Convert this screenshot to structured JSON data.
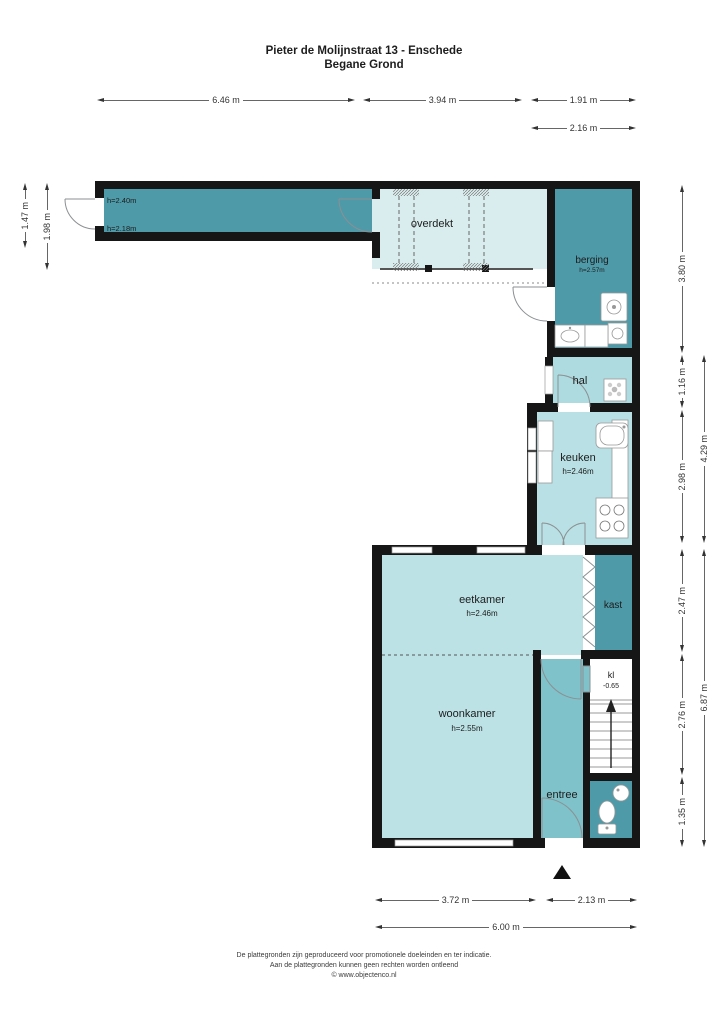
{
  "title": {
    "line1": "Pieter de Molijnstraat 13 - Enschede",
    "line2": "Begane Grond"
  },
  "rooms": {
    "corridor": {
      "height_top": "h=2.40m",
      "height_bottom": "h=2.18m"
    },
    "overdekt": {
      "label": "overdekt"
    },
    "berging": {
      "label": "berging",
      "height": "h=2.57m"
    },
    "hal": {
      "label": "hal"
    },
    "keuken": {
      "label": "keuken",
      "height": "h=2.46m"
    },
    "eetkamer": {
      "label": "eetkamer",
      "height": "h=2.46m"
    },
    "kast": {
      "label": "kast"
    },
    "woonkamer": {
      "label": "woonkamer",
      "height": "h=2.55m"
    },
    "entree": {
      "label": "entree"
    },
    "kl": {
      "label": "kl",
      "level": "-0.65"
    }
  },
  "dimensions": {
    "top": [
      "6.46 m",
      "3.94 m",
      "1.91 m",
      "2.16 m"
    ],
    "left": [
      "1.47 m",
      "1.98 m"
    ],
    "right": [
      "3.80 m",
      "1.16 m",
      "2.98 m",
      "4.29 m",
      "2.47 m",
      "2.76 m",
      "1.35 m",
      "6.87 m"
    ],
    "bottom": [
      "3.72 m",
      "2.13 m",
      "6.00 m"
    ]
  },
  "colors": {
    "wall": "#161616",
    "room_dark": "#4e9aa8",
    "room_medium": "#7fc2ca",
    "room_light": "#b9e0e4",
    "room_pale": "#d9edee"
  },
  "footer": {
    "line1": "De plattegronden zijn geproduceerd voor promotionele doeleinden en ter indicatie.",
    "line2": "Aan de plattegronden kunnen geen rechten worden ontleend",
    "line3": "© www.objectenco.nl"
  }
}
